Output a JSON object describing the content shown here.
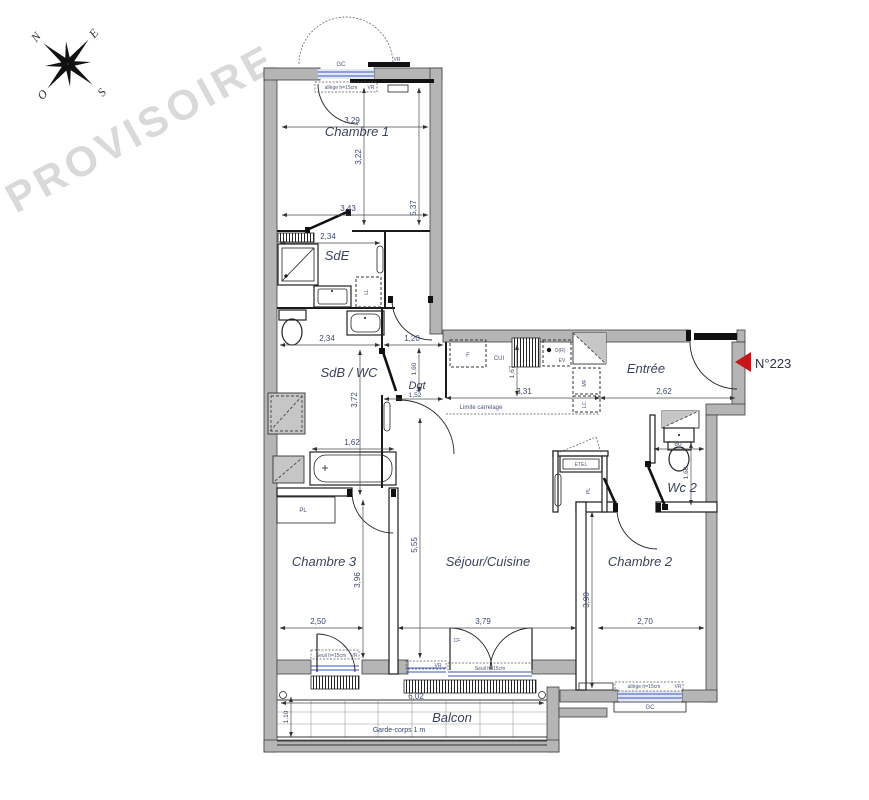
{
  "watermark": "PROVISOIRE",
  "compass": {
    "n": "N",
    "e": "E",
    "s": "S",
    "o": "O"
  },
  "unit": {
    "number": "N°223"
  },
  "rooms": {
    "chambre1": "Chambre 1",
    "sde": "SdE",
    "sdb_wc": "SdB / WC",
    "dgt": "Dgt",
    "entree": "Entrée",
    "wc2": "Wc 2",
    "chambre3": "Chambre 3",
    "sejour_cuisine": "Séjour/Cuisine",
    "chambre2": "Chambre 2",
    "balcon": "Balcon"
  },
  "dims": {
    "c1_top": "3,29",
    "c1_height": "3,22",
    "c1_bottom": "3,43",
    "c1_right": "5,37",
    "sde_width": "2,34",
    "sdb_width": "2,34",
    "dgt_top": "1,20",
    "sdb_height": "3,72",
    "bath_width": "1,62",
    "dgt_height": "1,60",
    "dgt_width": "1,52",
    "kitchen_height": "1,67",
    "kitchen_width": "3,31",
    "entree_width": "2,62",
    "wc2_width": "80",
    "wc2_height": "1,68",
    "c3_height": "3,96",
    "c3_width": "2,50",
    "sejour_height": "5,55",
    "sejour_width": "3,79",
    "c2_height": "3,90",
    "c2_width": "2,70",
    "balcon_width": "6,02",
    "balcon_depth": "1,10"
  },
  "annotations": {
    "allege": "allège h=15cm",
    "seuil": "Seuil h=15cm",
    "vr": "VR",
    "gc": "GC",
    "garde_corps": "Garde-corps 1 m",
    "limite_carrelage": "Limite carrelage",
    "etel": "ETEL",
    "pl": "PL",
    "cf": "CF"
  },
  "appliances": {
    "fridge": "F",
    "kitchen_unit": "CUI",
    "sink": "EV",
    "oven": "O(R)",
    "mf": "MF",
    "lc": "LC",
    "washer": "LL"
  }
}
